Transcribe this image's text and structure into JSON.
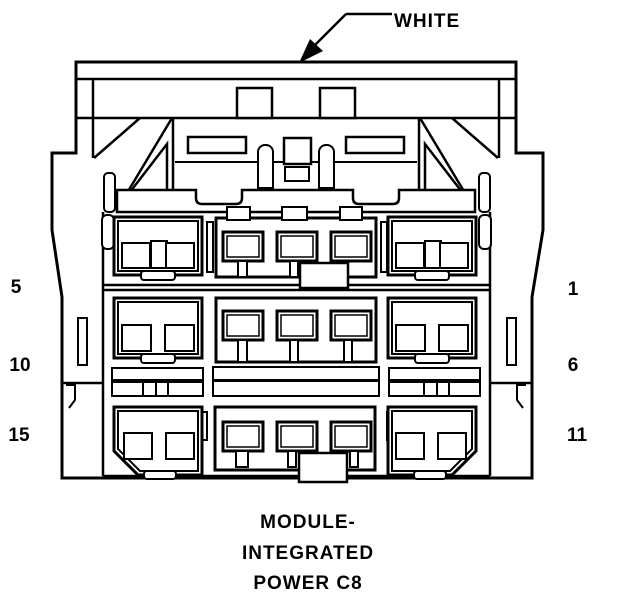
{
  "labels": {
    "connector_color": "WHITE"
  },
  "pins": {
    "top_left": "5",
    "mid_left": "10",
    "bottom_left": "15",
    "top_right": "1",
    "mid_right": "6",
    "bottom_right": "11"
  },
  "caption": {
    "line1": "MODULE-",
    "line2": "INTEGRATED",
    "line3": "POWER C8"
  },
  "colors": {
    "line": "#000000",
    "background": "#ffffff",
    "arrow_fill": "#000000"
  }
}
